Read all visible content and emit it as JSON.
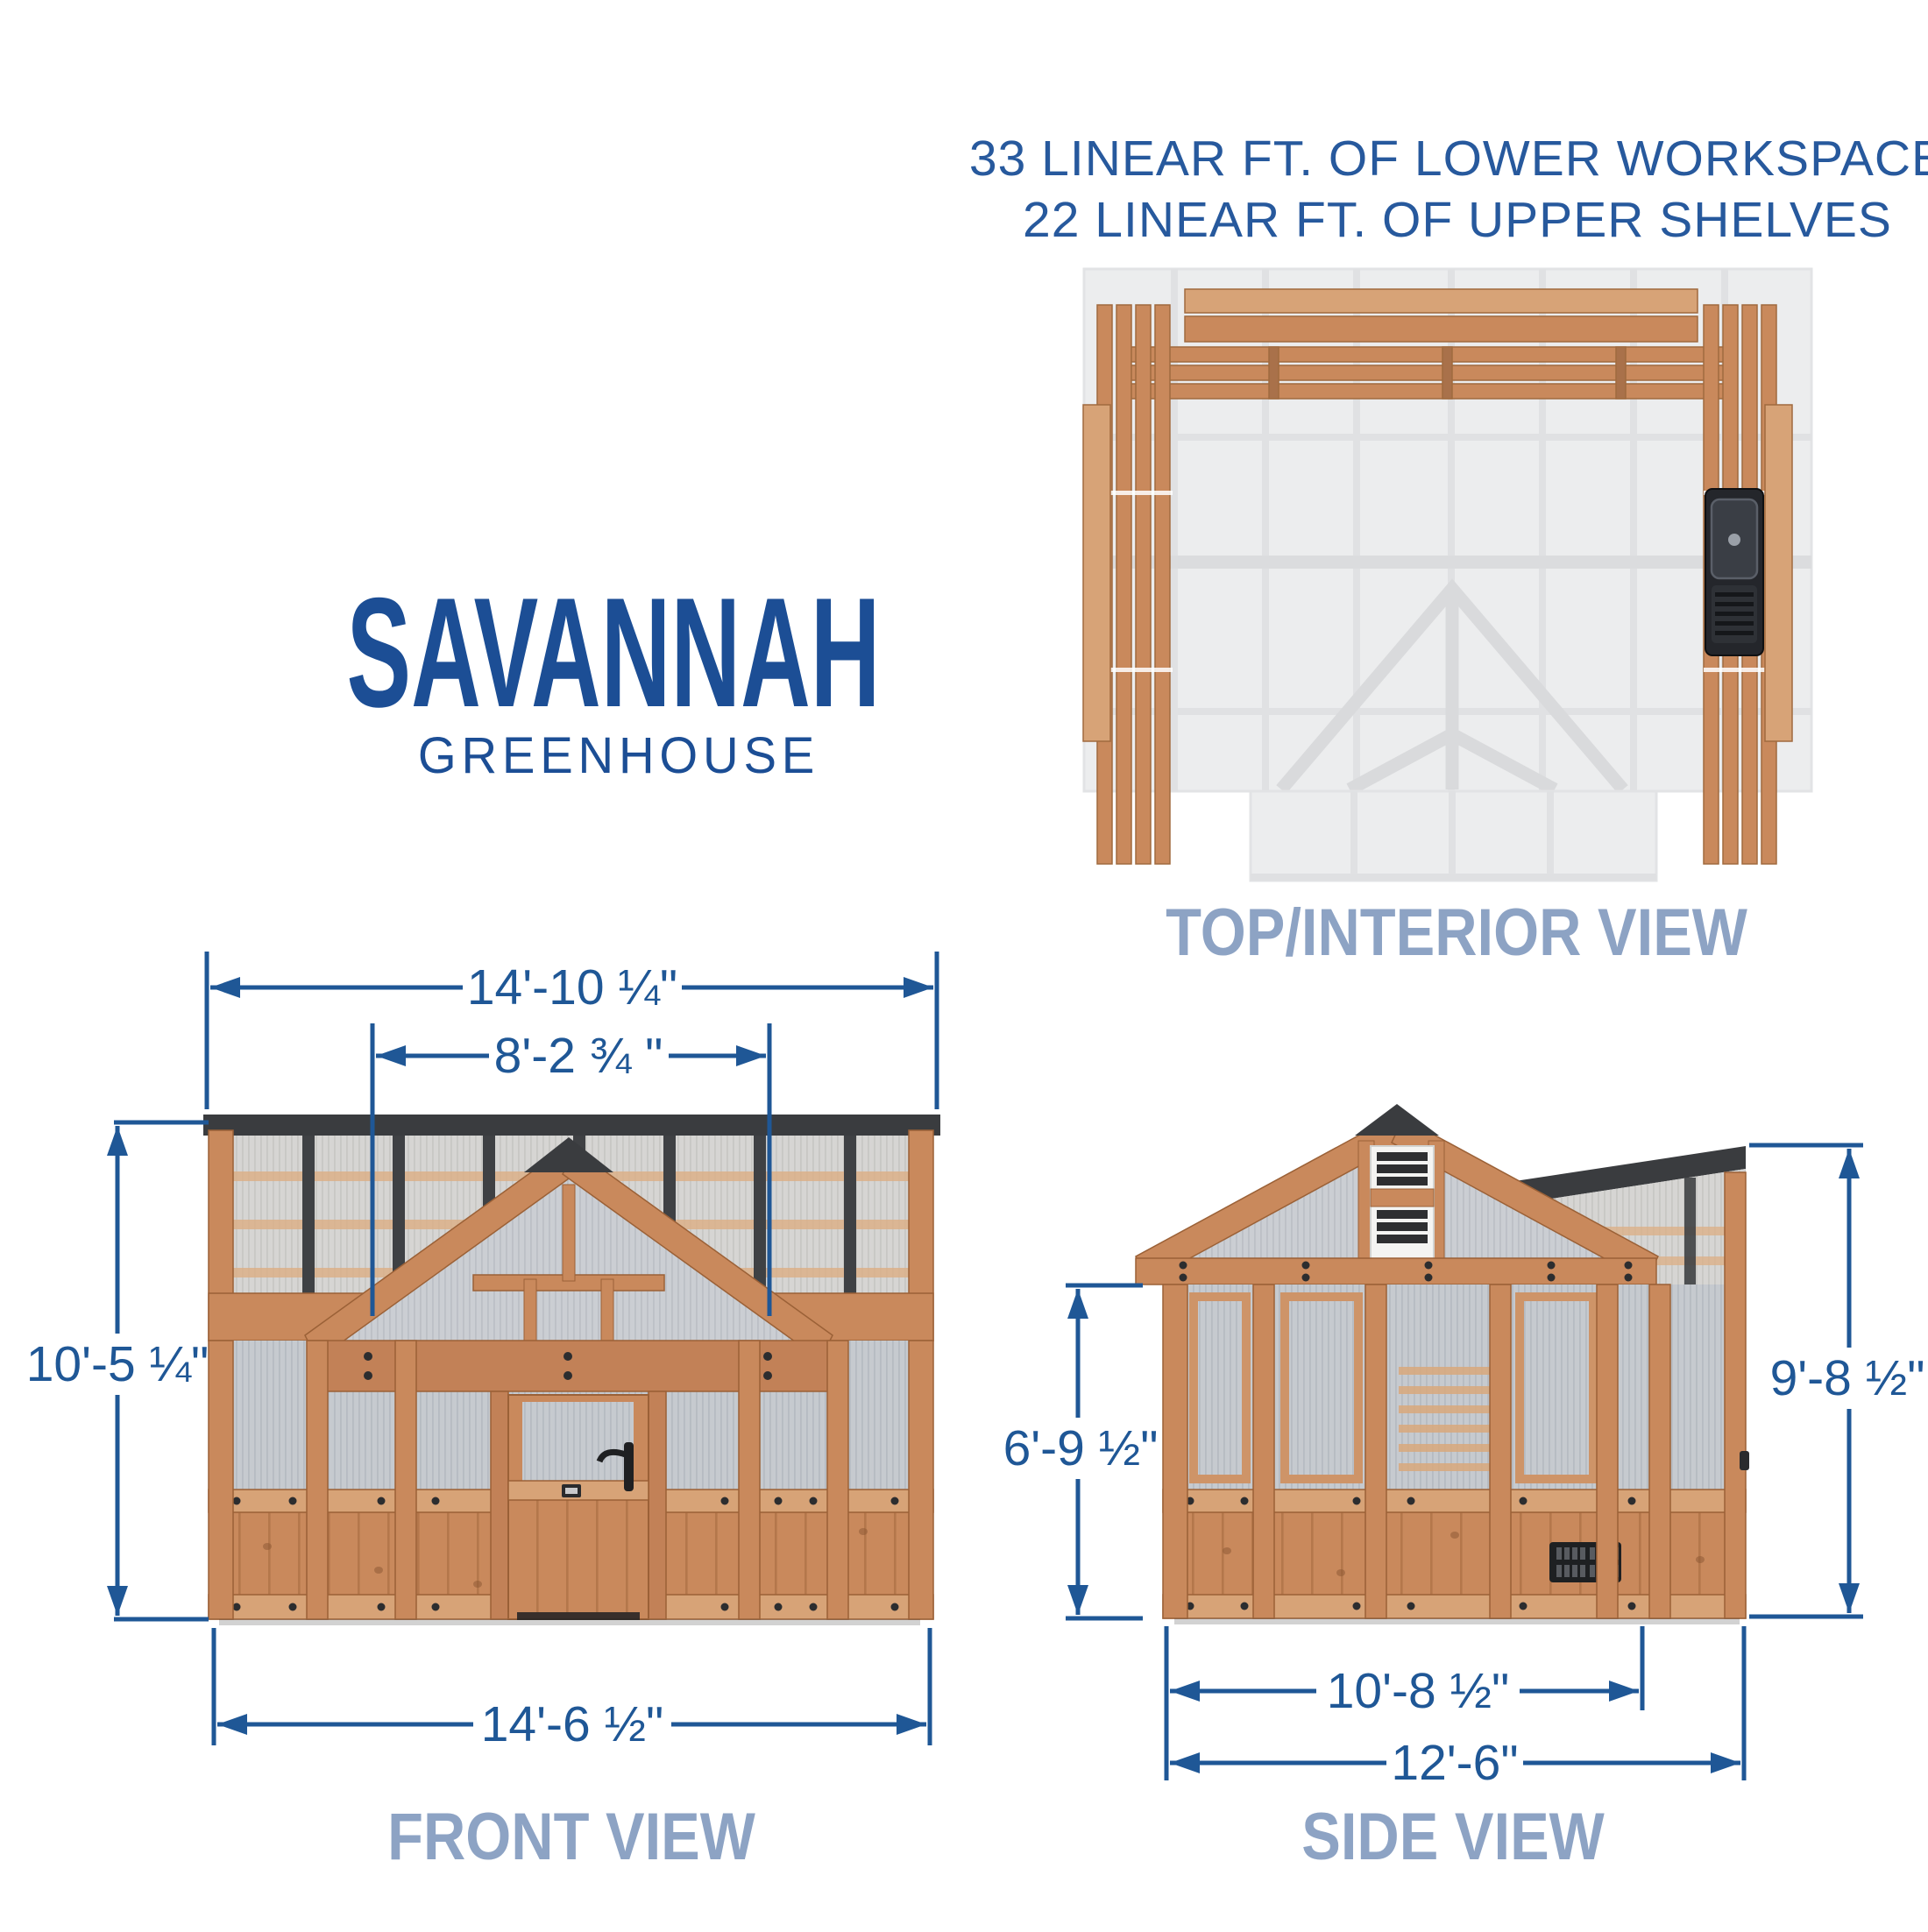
{
  "capacity": {
    "line1": "33 LINEAR FT. OF LOWER WORKSPACE",
    "line2": "22 LINEAR FT. OF UPPER SHELVES"
  },
  "title": {
    "name": "SAVANNAH",
    "type": "GREENHOUSE"
  },
  "top_view": {
    "label": "TOP/INTERIOR VIEW"
  },
  "front_view": {
    "label": "FRONT VIEW",
    "dim_overall_width": "14'-10 ¼\"",
    "dim_gable_width": "8'-2 ¾ \"",
    "dim_height": "10'-5 ¼\"",
    "dim_base_width": "14'-6 ½\""
  },
  "side_view": {
    "label": "SIDE VIEW",
    "dim_wall_height": "6'-9 ½\"",
    "dim_total_height": "9'-8 ½\"",
    "dim_main_depth": "10'-8 ½\"",
    "dim_total_depth": "12'-6\""
  },
  "colors": {
    "dimension_blue": "#1F5796",
    "title_blue": "#1C4E95",
    "view_label_slate": "#8DA3C4",
    "wood_main": "#C9895C",
    "wood_light": "#D7A377",
    "frame_dark": "#3A3C3F",
    "panel_gray": "#C6CACF"
  }
}
